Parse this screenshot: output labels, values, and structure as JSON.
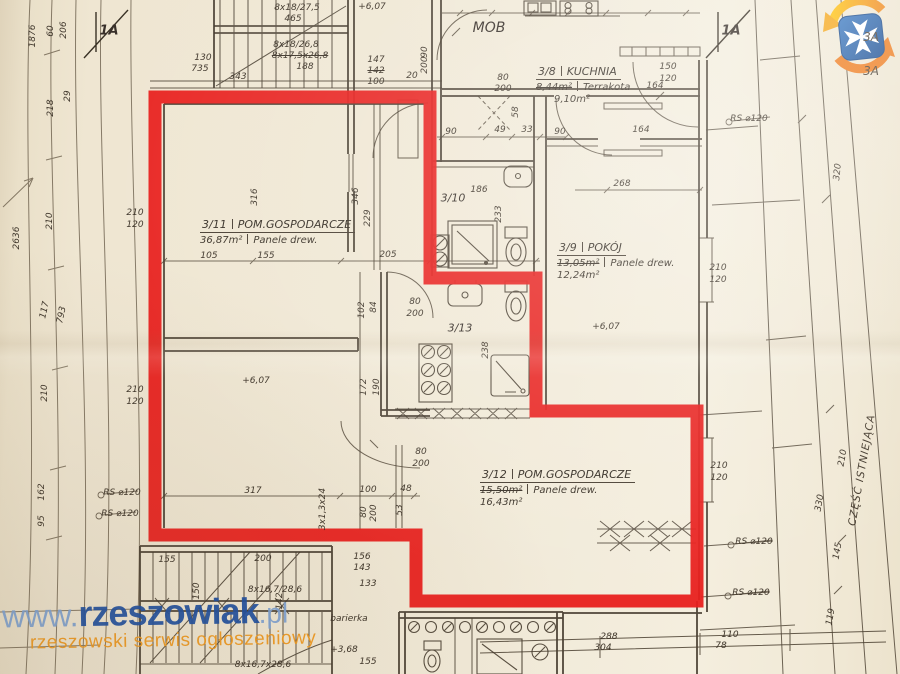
{
  "watermark": {
    "www": "www.",
    "name": "rzeszowiak",
    "tld": ".pl",
    "tagline": "rzeszowski serwis ogłoszeniowy"
  },
  "colors": {
    "outline_red": "#e8201d",
    "paper": "#f0e8d5",
    "ink": "#3e352a",
    "wm_blue": "#1e4fa1",
    "wm_light_blue": "#7fa3d4",
    "wm_orange": "#f09a20",
    "logo_blue": "#2a63ad",
    "logo_orange": "#ef7d20",
    "logo_yellow": "#f5a81c"
  },
  "markers": {
    "section_top_left": "1A",
    "section_top_right": "1A",
    "edge_label_1": "3A",
    "edge_label_2": "3A",
    "existing_part": "CZĘŚĆ ISTNIEJĄCA"
  },
  "rooms": {
    "r311": {
      "id": "3/11",
      "name": "POM.GOSPODARCZE",
      "area_old": "36,87m²",
      "floor": "Panele drew."
    },
    "r39": {
      "id": "3/9",
      "name": "POKÓJ",
      "area_old": "13,05m²",
      "floor": "Panele drew.",
      "area_new": "12,24m²"
    },
    "r312": {
      "id": "3/12",
      "name": "POM.GOSPODARCZE",
      "area_old": "15,50m²",
      "floor": "Panele drew.",
      "area_new": "16,43m²"
    },
    "r38": {
      "id": "3/8",
      "name": "KUCHNIA",
      "area_old": "8,44m²",
      "floor": "Terrakota",
      "area_new": "9,10m²"
    },
    "r310": {
      "id": "3/10"
    },
    "r313": {
      "id": "3/13"
    },
    "mob": {
      "id": "MOB"
    }
  },
  "dims": [
    {
      "t": "1876",
      "x": 33,
      "y": 36,
      "r": -90
    },
    {
      "t": "60",
      "x": 51,
      "y": 31,
      "r": -90
    },
    {
      "t": "206",
      "x": 64,
      "y": 30,
      "r": -90
    },
    {
      "t": "29",
      "x": 68,
      "y": 96,
      "r": -90
    },
    {
      "t": "218",
      "x": 51,
      "y": 108,
      "r": -90
    },
    {
      "t": "2636",
      "x": 17,
      "y": 238,
      "r": -90
    },
    {
      "t": "210",
      "x": 50,
      "y": 221,
      "r": -90
    },
    {
      "t": "210",
      "x": 135,
      "y": 213
    },
    {
      "t": "120",
      "x": 135,
      "y": 225
    },
    {
      "t": "117",
      "x": 45,
      "y": 310,
      "r": -78
    },
    {
      "t": "793",
      "x": 62,
      "y": 315,
      "r": -78
    },
    {
      "t": "210",
      "x": 45,
      "y": 393,
      "r": -90
    },
    {
      "t": "210",
      "x": 135,
      "y": 390
    },
    {
      "t": "120",
      "x": 135,
      "y": 402
    },
    {
      "t": "162",
      "x": 42,
      "y": 492,
      "r": -90
    },
    {
      "t": "95",
      "x": 42,
      "y": 521,
      "r": -90
    },
    {
      "t": "RS ⌀120",
      "x": 122,
      "y": 493
    },
    {
      "t": "RS ⌀120",
      "x": 120,
      "y": 514
    },
    {
      "t": "130",
      "x": 203,
      "y": 58
    },
    {
      "t": "735",
      "x": 200,
      "y": 69
    },
    {
      "t": "8x18/27,5",
      "x": 297,
      "y": 8
    },
    {
      "t": "465",
      "x": 293,
      "y": 19
    },
    {
      "t": "8x18/26,8",
      "x": 296,
      "y": 45
    },
    {
      "t": "8x17,5x26,8",
      "x": 300,
      "y": 56,
      "s": true
    },
    {
      "t": "188",
      "x": 305,
      "y": 67
    },
    {
      "t": "343",
      "x": 238,
      "y": 77
    },
    {
      "t": "147",
      "x": 376,
      "y": 60
    },
    {
      "t": "142",
      "x": 376,
      "y": 71,
      "s": true
    },
    {
      "t": "100",
      "x": 376,
      "y": 82
    },
    {
      "t": "20",
      "x": 412,
      "y": 76
    },
    {
      "t": "+6,07",
      "x": 372,
      "y": 7
    },
    {
      "t": "90",
      "x": 425,
      "y": 52,
      "r": -90
    },
    {
      "t": "200",
      "x": 425,
      "y": 65,
      "r": -90
    },
    {
      "t": "80",
      "x": 503,
      "y": 78
    },
    {
      "t": "200",
      "x": 503,
      "y": 89
    },
    {
      "t": "90",
      "x": 451,
      "y": 132
    },
    {
      "t": "49",
      "x": 500,
      "y": 130
    },
    {
      "t": "33",
      "x": 527,
      "y": 130
    },
    {
      "t": "90",
      "x": 560,
      "y": 132
    },
    {
      "t": "58",
      "x": 516,
      "y": 112,
      "r": -90
    },
    {
      "t": "150",
      "x": 668,
      "y": 67
    },
    {
      "t": "120",
      "x": 668,
      "y": 79
    },
    {
      "t": "164",
      "x": 655,
      "y": 86
    },
    {
      "t": "RS ⌀120",
      "x": 749,
      "y": 119
    },
    {
      "t": "164",
      "x": 641,
      "y": 130
    },
    {
      "t": "268",
      "x": 622,
      "y": 184
    },
    {
      "t": "210",
      "x": 718,
      "y": 268
    },
    {
      "t": "120",
      "x": 718,
      "y": 280
    },
    {
      "t": "316",
      "x": 255,
      "y": 197,
      "r": -90
    },
    {
      "t": "346",
      "x": 356,
      "y": 196,
      "r": -90
    },
    {
      "t": "229",
      "x": 368,
      "y": 218,
      "r": -90
    },
    {
      "t": "105",
      "x": 209,
      "y": 256
    },
    {
      "t": "155",
      "x": 266,
      "y": 256
    },
    {
      "t": "205",
      "x": 388,
      "y": 255
    },
    {
      "t": "186",
      "x": 479,
      "y": 190
    },
    {
      "t": "233",
      "x": 499,
      "y": 214,
      "r": -90
    },
    {
      "t": "102",
      "x": 362,
      "y": 310,
      "r": -90
    },
    {
      "t": "84",
      "x": 374,
      "y": 307,
      "r": -90
    },
    {
      "t": "80",
      "x": 415,
      "y": 302
    },
    {
      "t": "200",
      "x": 415,
      "y": 314
    },
    {
      "t": "238",
      "x": 486,
      "y": 350,
      "r": -90
    },
    {
      "t": "+6,07",
      "x": 606,
      "y": 327
    },
    {
      "t": "172",
      "x": 364,
      "y": 387,
      "r": -90
    },
    {
      "t": "190",
      "x": 377,
      "y": 387,
      "r": -90
    },
    {
      "t": "+6,07",
      "x": 256,
      "y": 381
    },
    {
      "t": "80",
      "x": 421,
      "y": 452
    },
    {
      "t": "200",
      "x": 421,
      "y": 464
    },
    {
      "t": "317",
      "x": 253,
      "y": 491
    },
    {
      "t": "100",
      "x": 368,
      "y": 490
    },
    {
      "t": "48",
      "x": 406,
      "y": 489
    },
    {
      "t": "3x1,3x24",
      "x": 323,
      "y": 509,
      "r": -90
    },
    {
      "t": "80",
      "x": 364,
      "y": 512,
      "r": -90
    },
    {
      "t": "200",
      "x": 374,
      "y": 513,
      "r": -90
    },
    {
      "t": "53",
      "x": 400,
      "y": 510,
      "r": -90
    },
    {
      "t": "210",
      "x": 719,
      "y": 466
    },
    {
      "t": "120",
      "x": 719,
      "y": 478
    },
    {
      "t": "RS ⌀120",
      "x": 754,
      "y": 542
    },
    {
      "t": "RS ⌀120",
      "x": 751,
      "y": 593
    },
    {
      "t": "155",
      "x": 167,
      "y": 560
    },
    {
      "t": "200",
      "x": 263,
      "y": 559
    },
    {
      "t": "156",
      "x": 362,
      "y": 557
    },
    {
      "t": "143",
      "x": 362,
      "y": 568
    },
    {
      "t": "133",
      "x": 368,
      "y": 584
    },
    {
      "t": "8x16,7/28,6",
      "x": 275,
      "y": 590
    },
    {
      "t": "150",
      "x": 197,
      "y": 591,
      "r": -90
    },
    {
      "t": "142",
      "x": 280,
      "y": 601,
      "r": -90
    },
    {
      "t": "barierka",
      "x": 349,
      "y": 619
    },
    {
      "t": "8x16,7x28,6",
      "x": 263,
      "y": 665
    },
    {
      "t": "+3,68",
      "x": 344,
      "y": 650
    },
    {
      "t": "155",
      "x": 368,
      "y": 662
    },
    {
      "t": "288",
      "x": 609,
      "y": 637
    },
    {
      "t": "304",
      "x": 603,
      "y": 648
    },
    {
      "t": "110",
      "x": 730,
      "y": 635
    },
    {
      "t": "78",
      "x": 721,
      "y": 646
    },
    {
      "t": "210",
      "x": 843,
      "y": 458,
      "r": -80
    },
    {
      "t": "330",
      "x": 820,
      "y": 503,
      "r": -80
    },
    {
      "t": "145",
      "x": 838,
      "y": 551,
      "r": -80
    },
    {
      "t": "119",
      "x": 831,
      "y": 617,
      "r": -80
    },
    {
      "t": "320",
      "x": 838,
      "y": 172,
      "r": -84
    }
  ]
}
